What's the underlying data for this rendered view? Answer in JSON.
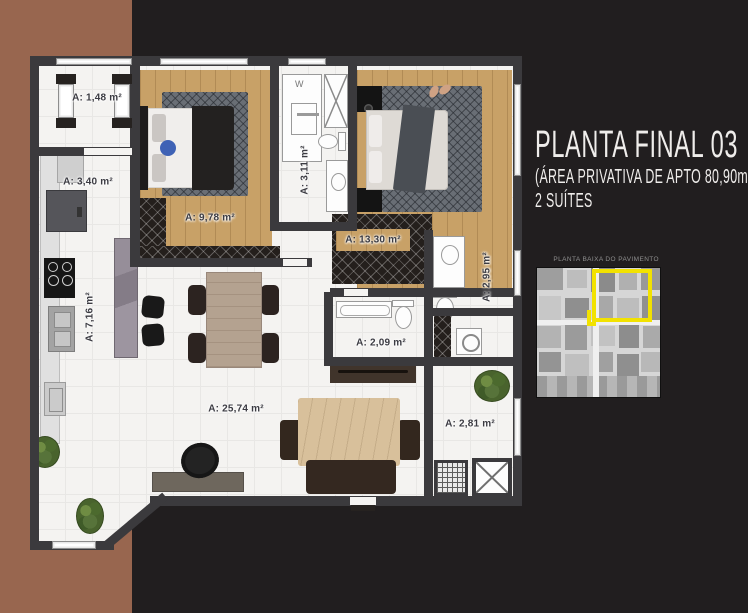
{
  "title": {
    "line1": "PLANTA FINAL 03",
    "line2": "(ÁREA PRIVATIVA DE APTO 80,90m2)",
    "line3": "2 SUÍTES"
  },
  "miniplan": {
    "caption": "PLANTA BAIXA DO PAVIMENTO",
    "highlight_color": "#f2e200"
  },
  "rooms": {
    "varanda_frente": {
      "label": "A: 1,48 m²",
      "area_m2": 1.48
    },
    "copa": {
      "label": "A: 3,40 m²",
      "area_m2": 3.4
    },
    "suite1": {
      "label": "A: 9,78 m²",
      "area_m2": 9.78
    },
    "banheiro1": {
      "label": "A: 3,11 m²",
      "area_m2": 3.11
    },
    "suite2": {
      "label": "A: 13,30 m²",
      "area_m2": 13.3
    },
    "banheiro2": {
      "label": "A: 2,95 m²",
      "area_m2": 2.95
    },
    "lavabo": {
      "label": "A: 2,09 m²",
      "area_m2": 2.09
    },
    "cozinha": {
      "label": "A: 7,16 m²",
      "area_m2": 7.16
    },
    "sala": {
      "label": "A: 25,74 m²",
      "area_m2": 25.74
    },
    "varanda_servico": {
      "label": "A: 2,81 m²",
      "area_m2": 2.81
    }
  },
  "colors": {
    "background": "#211e1f",
    "accent_band": "#98664f",
    "wall": "#3b3a3d",
    "wood_floor": "#c8a167",
    "highlight": "#f2e200"
  }
}
